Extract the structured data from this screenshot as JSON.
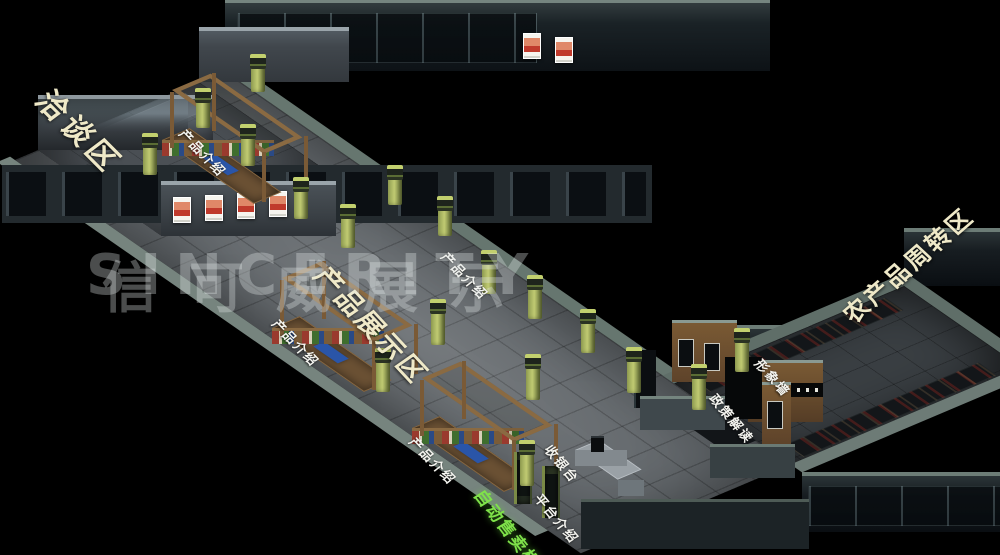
{
  "watermark": {
    "latin": "SINCERITY",
    "cjk": "信可威展示"
  },
  "zones": {
    "negotiation": "洽谈区",
    "display": "产品展示区",
    "turnover": "农产品周转区"
  },
  "labels": {
    "product_intro": "产品介绍",
    "cashier": "收银台",
    "platform": "平台介绍",
    "vending": "自动售卖柜",
    "image_wall": "形象墙",
    "policy": "政策解读"
  },
  "palette": {
    "background": "#000000",
    "floor_grey": "#63686c",
    "wing_floor": "#3a3f43",
    "wall_dark": "#1a2226",
    "wall_top_light": "#75857f",
    "pillar_green": "#a9b561",
    "wood": "#7b5c38",
    "label_cream": "#efe9c8",
    "label_white": "#f4f4ef",
    "label_green": "#7fe24a",
    "watermark_grey": "rgba(228,234,234,0.33)"
  }
}
